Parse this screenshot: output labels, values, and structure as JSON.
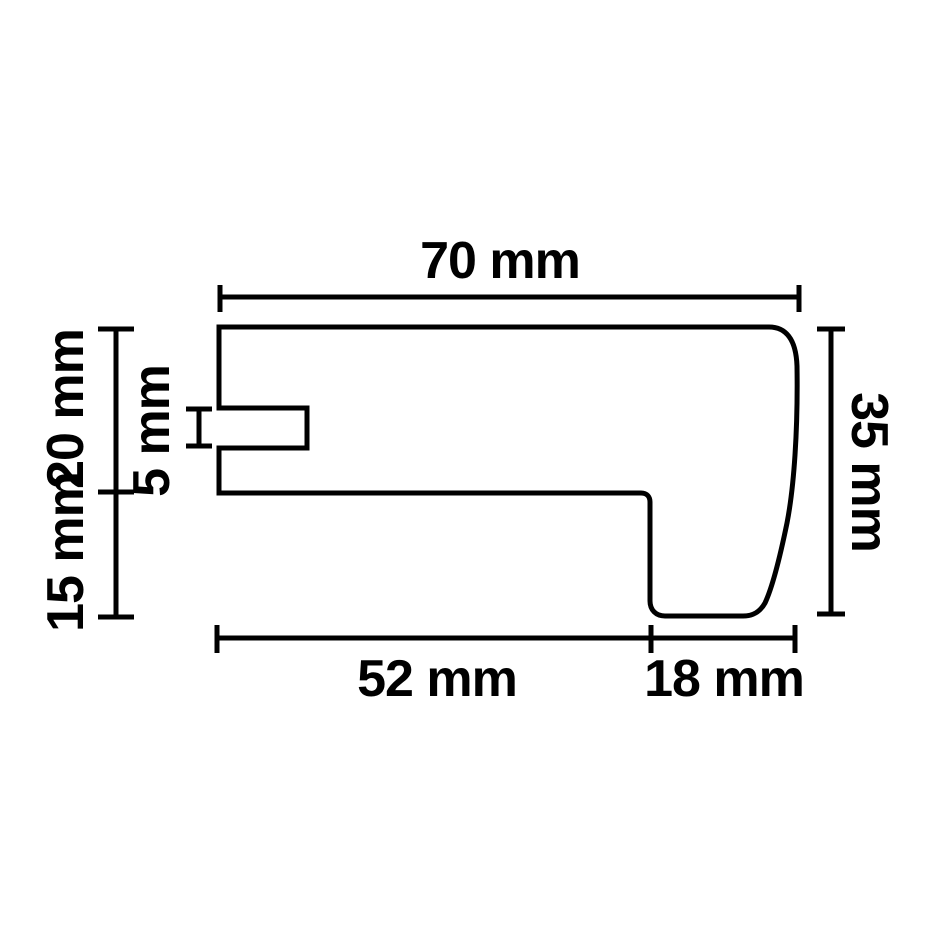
{
  "diagram": {
    "kind": "technical-profile-cross-section-drawing",
    "style": {
      "line_color": "#000000",
      "background_color": "#ffffff"
    },
    "dimensions": {
      "top_width": "70 mm",
      "right_height": "35 mm",
      "left_upper_height": "20 mm",
      "left_lower_height": "15 mm",
      "groove_height": "5 mm",
      "bottom_left_width": "52 mm",
      "bottom_right_width": "18 mm"
    }
  }
}
